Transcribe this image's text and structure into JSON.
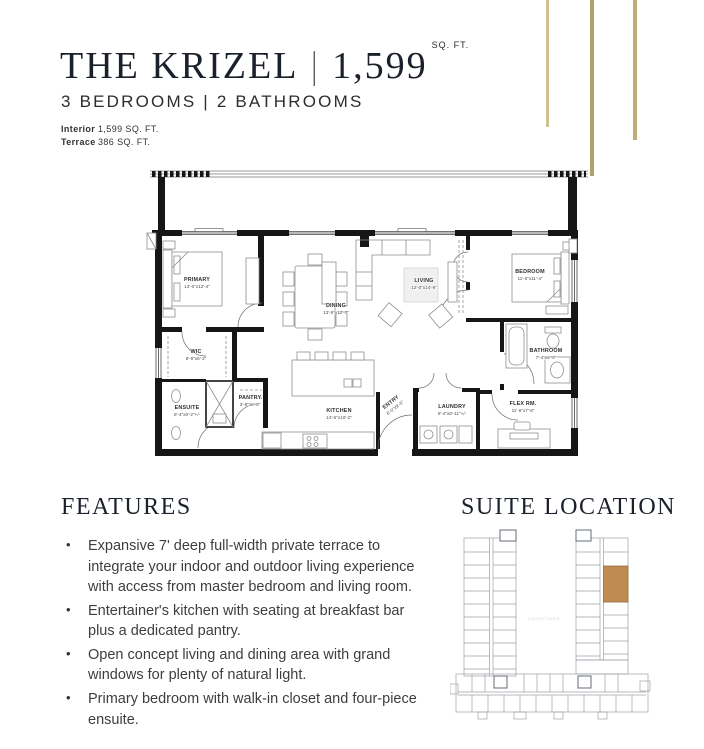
{
  "header": {
    "title": {
      "name": "THE KRIZEL",
      "separator": "|",
      "area": "1,599",
      "area_unit": "SQ. FT."
    },
    "subtitle": "3 BEDROOMS | 2 BATHROOMS",
    "stats": [
      {
        "label": "Interior",
        "value": "1,599  SQ. FT."
      },
      {
        "label": "Terrace",
        "value": "386  SQ. FT."
      }
    ],
    "accent_bar_colors": [
      "#cfc190",
      "#b49e6b",
      "#c0ad77"
    ]
  },
  "floorplan": {
    "rooms": [
      {
        "name": "PRIMARY",
        "dims": "13'-0\"x12'-4\""
      },
      {
        "name": "WIC",
        "dims": "8'-8\"x6'-2\""
      },
      {
        "name": "ENSUITE",
        "dims": "8'-4\"x9'-2\"+/-"
      },
      {
        "name": "PANTRY",
        "dims": "3'-6\"x6'-0\""
      },
      {
        "name": "KITCHEN",
        "dims": "14'-6\"x10'-2\""
      },
      {
        "name": "ENTRY",
        "dims": "6'-0\"x9'-6\""
      },
      {
        "name": "DINING",
        "dims": "13'-9\"x12'-7\""
      },
      {
        "name": "LIVING",
        "dims": "12'-0\"x14'-9\""
      },
      {
        "name": "BEDROOM",
        "dims": "11'-6\"x11'-4\""
      },
      {
        "name": "BATHROOM",
        "dims": "7'-4\"x5'-0\""
      },
      {
        "name": "LAUNDRY",
        "dims": "5'-4\"x8'-11\"+/-"
      },
      {
        "name": "FLEX RM.",
        "dims": "11'-6\"x7'-6\""
      }
    ]
  },
  "features": {
    "title": "FEATURES",
    "bullets": [
      "Expansive 7' deep full-width private terrace to integrate your indoor and outdoor living experience with access from master bedroom and living room.",
      "Entertainer's kitchen with seating at breakfast bar plus a dedicated pantry.",
      "Open concept living and dining area with grand windows for plenty of natural light.",
      "Primary bedroom with walk-in closet and four-piece ensuite."
    ]
  },
  "suite_location": {
    "title": "SUITE LOCATION",
    "courtyard_label": "COURTYARD",
    "highlight_color": "#c08b50"
  }
}
